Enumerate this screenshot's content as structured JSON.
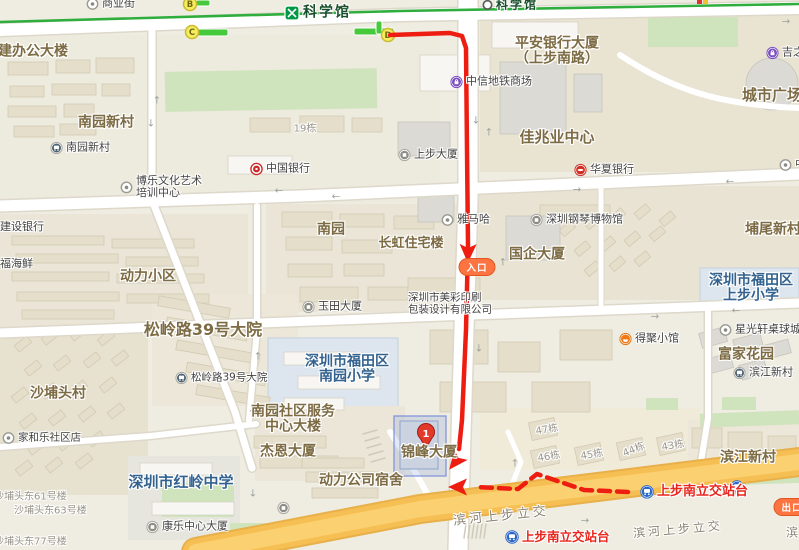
{
  "colors": {
    "route": "#ee1d11",
    "metro_line": "#2fae3e",
    "highway": "#f6bf53",
    "highway_edge": "#e8b04a",
    "transit": "#e8261d",
    "area": "#7d6b44",
    "school": "#33628f",
    "grey": "#98948a",
    "poi": "#434343",
    "roadlbl": "#8a8272",
    "station": "#174f2b",
    "capsule": "#fd7443",
    "exit_fill": "#f6ec5d",
    "exit_ring": "#c9bb2e",
    "exit_letter": "#6f6a15",
    "bus_blue": "#2a66c8"
  },
  "metro": {
    "line": [
      [
        0,
        22
      ],
      [
        400,
        11
      ],
      [
        799,
        4
      ]
    ],
    "logo": {
      "x": 292,
      "y": 13
    },
    "exits": [
      {
        "t": "B",
        "x": 190,
        "y": 4
      },
      {
        "t": "C",
        "x": 192,
        "y": 32
      },
      {
        "t": "D",
        "x": 388,
        "y": 35
      }
    ],
    "exit_bars": [
      [
        196,
        0,
        14,
        6
      ],
      [
        197,
        29,
        31,
        7
      ],
      [
        354,
        28,
        40,
        7
      ],
      [
        376,
        21,
        6,
        13
      ]
    ],
    "partial_marker": {
      "x": 697,
      "y": 0
    }
  },
  "route": {
    "main": [
      [
        390,
        35
      ],
      [
        450,
        33
      ],
      [
        462,
        36
      ],
      [
        466,
        48
      ],
      [
        467,
        150
      ],
      [
        468,
        246
      ],
      [
        466,
        330
      ],
      [
        462,
        420
      ],
      [
        459,
        449
      ]
    ],
    "main_arrows": [
      {
        "x": 468,
        "y": 252,
        "a": 91
      },
      {
        "x": 456,
        "y": 461,
        "a": 128
      }
    ],
    "dashed": [
      [
        628,
        492
      ],
      [
        584,
        490
      ],
      [
        537,
        474
      ],
      [
        518,
        489
      ],
      [
        476,
        487
      ]
    ],
    "dashed_arrows": [
      {
        "x": 459,
        "y": 487,
        "a": 180
      }
    ],
    "entrance": {
      "t": "入口",
      "x": 477,
      "y": 267
    },
    "exit": {
      "t": "出口",
      "x": 792,
      "y": 507
    }
  },
  "destination": {
    "number": "1",
    "x": 426,
    "y": 448,
    "building": {
      "x": 394,
      "y": 416,
      "w": 52,
      "h": 60
    }
  },
  "road_arrows": [
    {
      "g": "↑",
      "x": 157,
      "y": 101
    },
    {
      "g": "↓",
      "x": 151,
      "y": 124
    },
    {
      "g": "↓",
      "x": 476,
      "y": 121
    },
    {
      "g": "↑",
      "x": 489,
      "y": 133
    },
    {
      "g": "←",
      "x": 279,
      "y": 191
    },
    {
      "g": "←",
      "x": 336,
      "y": 197
    },
    {
      "g": "→",
      "x": 577,
      "y": 190
    },
    {
      "g": "←",
      "x": 730,
      "y": 182
    },
    {
      "g": "→",
      "x": 655,
      "y": 317
    },
    {
      "g": "←",
      "x": 736,
      "y": 311
    },
    {
      "g": "↑",
      "x": 258,
      "y": 357
    },
    {
      "g": "↑",
      "x": 252,
      "y": 414
    },
    {
      "g": "↓",
      "x": 253,
      "y": 494
    },
    {
      "g": "↑",
      "x": 503,
      "y": 263
    },
    {
      "g": "↓",
      "x": 479,
      "y": 349
    },
    {
      "g": "→",
      "x": 585,
      "y": 521
    },
    {
      "g": "↑",
      "x": 515,
      "y": 464
    },
    {
      "g": "→",
      "x": 786,
      "y": 22
    }
  ],
  "labels": [
    {
      "t": "建办公大楼",
      "x": -2,
      "y": 52,
      "cls": "area",
      "size": 14,
      "anchor": "l",
      "name": "area-jian-bangong-dalou",
      "inter": false
    },
    {
      "t": "南园新村",
      "x": 106,
      "y": 123,
      "cls": "area",
      "size": 14,
      "anchor": "c",
      "name": "area-nanyuan-xincun",
      "inter": false
    },
    {
      "t": "动力小区",
      "x": 148,
      "y": 277,
      "cls": "area",
      "size": 14,
      "anchor": "c",
      "name": "area-dongli-xiaoqu",
      "inter": false
    },
    {
      "t": "南园",
      "x": 331,
      "y": 230,
      "cls": "area",
      "size": 14,
      "anchor": "c",
      "name": "area-nanyuan",
      "inter": false
    },
    {
      "t": "长虹住宅楼",
      "x": 411,
      "y": 244,
      "cls": "area",
      "size": 13,
      "anchor": "c",
      "name": "area-changhong-zhuzhailou",
      "inter": false
    },
    {
      "t": "松岭路39号大院",
      "x": 203,
      "y": 330,
      "cls": "area",
      "size": 16,
      "anchor": "c",
      "name": "area-songlinglu-39",
      "inter": false
    },
    {
      "t": "沙埔头村",
      "x": 58,
      "y": 394,
      "cls": "area",
      "size": 14,
      "anchor": "c",
      "name": "area-shabutou-cun",
      "inter": false
    },
    {
      "lines": [
        "南园社区服务",
        "中心大楼"
      ],
      "x": 293,
      "y": 420,
      "cls": "area",
      "size": 14,
      "anchor": "c",
      "name": "area-nanyuan-shequ-center",
      "inter": false
    },
    {
      "t": "杰恩大厦",
      "x": 288,
      "y": 452,
      "cls": "area",
      "size": 14,
      "anchor": "c",
      "name": "area-jieen-dasha",
      "inter": false
    },
    {
      "t": "动力公司宿舍",
      "x": 361,
      "y": 481,
      "cls": "area",
      "size": 14,
      "anchor": "c",
      "name": "area-dongli-sushe",
      "inter": false
    },
    {
      "t": "锦峰大厦",
      "x": 429,
      "y": 453,
      "cls": "area",
      "size": 14,
      "anchor": "c",
      "name": "area-jinfeng-dasha",
      "inter": false
    },
    {
      "t": "国企大厦",
      "x": 537,
      "y": 255,
      "cls": "area",
      "size": 14,
      "anchor": "c",
      "name": "area-guoqi-dasha",
      "inter": false
    },
    {
      "t": "佳兆业中心",
      "x": 557,
      "y": 137,
      "cls": "area",
      "size": 15,
      "anchor": "c",
      "name": "area-jiazhaoye-center",
      "inter": false
    },
    {
      "lines": [
        "平安银行大厦",
        "（上步南路）"
      ],
      "x": 557,
      "y": 52,
      "cls": "area",
      "size": 14,
      "anchor": "c",
      "name": "area-pingan-bank-tower",
      "inter": false
    },
    {
      "t": "城市广场",
      "x": 772,
      "y": 95,
      "cls": "area",
      "size": 15,
      "anchor": "c",
      "name": "area-chengshi-guangchang",
      "inter": false
    },
    {
      "t": "埔尾新村",
      "x": 773,
      "y": 230,
      "cls": "area",
      "size": 14,
      "anchor": "c",
      "name": "area-puwei-xincun",
      "inter": false
    },
    {
      "t": "富家花园",
      "x": 746,
      "y": 355,
      "cls": "area",
      "size": 14,
      "anchor": "c",
      "name": "area-fujia-huayuan",
      "inter": false
    },
    {
      "t": "滨江新村",
      "x": 748,
      "y": 458,
      "cls": "area",
      "size": 14,
      "anchor": "c",
      "name": "area-binjiang-xincun",
      "inter": false
    },
    {
      "lines": [
        "深圳市福田区",
        "南园小学"
      ],
      "x": 347,
      "y": 370,
      "cls": "school",
      "size": 14,
      "anchor": "c",
      "name": "school-nanyuan-primary",
      "inter": false
    },
    {
      "lines": [
        "深圳市福田区",
        "上步小学"
      ],
      "x": 751,
      "y": 289,
      "cls": "school",
      "size": 14,
      "anchor": "c",
      "name": "school-shangbu-primary",
      "inter": false
    },
    {
      "t": "深圳市红岭中学",
      "x": 181,
      "y": 482,
      "cls": "school",
      "size": 15,
      "anchor": "c",
      "name": "school-hongling-middle",
      "inter": false
    },
    {
      "t": "19栋",
      "x": 305,
      "y": 129,
      "cls": "grey",
      "size": 10,
      "anchor": "c",
      "name": "bldg-no-19",
      "inter": false
    },
    {
      "t": "47栋",
      "x": 547,
      "y": 430,
      "cls": "grey",
      "size": 10,
      "anchor": "c",
      "rot": -10,
      "name": "bldg-no-47",
      "inter": false
    },
    {
      "t": "46栋",
      "x": 549,
      "y": 457,
      "cls": "grey",
      "size": 10,
      "anchor": "c",
      "rot": -10,
      "name": "bldg-no-46",
      "inter": false
    },
    {
      "t": "45栋",
      "x": 592,
      "y": 455,
      "cls": "grey",
      "size": 10,
      "anchor": "c",
      "rot": -10,
      "name": "bldg-no-45",
      "inter": false
    },
    {
      "t": "44栋",
      "x": 634,
      "y": 450,
      "cls": "grey",
      "size": 10,
      "anchor": "c",
      "rot": -22,
      "name": "bldg-no-44",
      "inter": false
    },
    {
      "t": "43栋",
      "x": 673,
      "y": 446,
      "cls": "grey",
      "size": 10,
      "anchor": "c",
      "rot": -10,
      "name": "bldg-no-43",
      "inter": false
    },
    {
      "t": "沙埔头东61号楼",
      "x": -6,
      "y": 497,
      "cls": "grey",
      "size": 10,
      "anchor": "l",
      "name": "bldg-shabutou-61",
      "inter": false
    },
    {
      "t": "沙埔头东63号楼",
      "x": 14,
      "y": 511,
      "cls": "grey",
      "size": 10,
      "anchor": "l",
      "name": "bldg-shabutou-63",
      "inter": false
    },
    {
      "t": "沙埔头东77号楼",
      "x": -6,
      "y": 542,
      "cls": "grey",
      "size": 10,
      "anchor": "l",
      "name": "bldg-shabutou-77",
      "inter": false
    },
    {
      "t": "商业街",
      "x": 86,
      "y": 4,
      "cls": "poi",
      "size": 11,
      "anchor": "l",
      "icon": "poi-dot",
      "name": "poi-shangyejie",
      "inter": true
    },
    {
      "t": "南园新村",
      "x": 50,
      "y": 148,
      "cls": "poi",
      "size": 11,
      "anchor": "l",
      "icon": "bus-grey",
      "name": "busstop-nanyuan-xincun",
      "inter": true
    },
    {
      "lines": [
        "博乐文化艺术",
        "培训中心"
      ],
      "x": 120,
      "y": 187,
      "cls": "poi",
      "size": 11,
      "anchor": "l",
      "icon": "poi-dot",
      "name": "poi-bole-art-center",
      "inter": true
    },
    {
      "t": "中国银行",
      "x": 250,
      "y": 169,
      "cls": "poi",
      "size": 11,
      "anchor": "l",
      "icon": "bank-red",
      "name": "poi-bank-of-china",
      "inter": true
    },
    {
      "t": "建设银行",
      "x": 0,
      "y": 227,
      "cls": "poi",
      "size": 11,
      "anchor": "l",
      "name": "poi-ccb-bank",
      "inter": true
    },
    {
      "t": "福海鲜",
      "x": 0,
      "y": 264,
      "cls": "poi",
      "size": 11,
      "anchor": "l",
      "name": "poi-fuhaixian",
      "inter": true
    },
    {
      "t": "玉田大厦",
      "x": 302,
      "y": 307,
      "cls": "poi",
      "size": 11,
      "anchor": "l",
      "icon": "poi-building",
      "name": "poi-yutian-dasha",
      "inter": true
    },
    {
      "t": "松岭路39号大院",
      "x": 175,
      "y": 378,
      "cls": "poi",
      "size": 10.5,
      "anchor": "l",
      "icon": "bus-grey",
      "name": "busstop-songlinglu-39",
      "inter": true
    },
    {
      "lines": [
        "深圳市美彩印刷",
        "包装设计有限公司"
      ],
      "x": 408,
      "y": 304,
      "cls": "poi",
      "size": 10.5,
      "anchor": "l",
      "name": "poi-meicai-printing",
      "inter": true
    },
    {
      "t": "家和乐社区店",
      "x": 2,
      "y": 438,
      "cls": "poi",
      "size": 10.5,
      "anchor": "l",
      "icon": "poi-dot",
      "name": "poi-jiahele-store",
      "inter": true
    },
    {
      "t": "康乐中心大厦",
      "x": 146,
      "y": 527,
      "cls": "poi",
      "size": 11,
      "anchor": "l",
      "icon": "poi-building",
      "name": "poi-kangle-center",
      "inter": true
    },
    {
      "t": "上步大厦",
      "x": 398,
      "y": 155,
      "cls": "poi",
      "size": 11,
      "anchor": "l",
      "icon": "poi-building",
      "name": "poi-shangbu-dasha",
      "inter": true
    },
    {
      "t": "雅马哈",
      "x": 441,
      "y": 220,
      "cls": "poi",
      "size": 11,
      "anchor": "l",
      "icon": "poi-dot",
      "name": "poi-yamaha",
      "inter": true
    },
    {
      "t": "中信地铁商场",
      "x": 450,
      "y": 82,
      "cls": "poi",
      "size": 11,
      "anchor": "l",
      "icon": "mall-purple",
      "name": "poi-zhongxin-metro-mall",
      "inter": true
    },
    {
      "t": "吉之岛",
      "x": 766,
      "y": 53,
      "cls": "poi",
      "size": 11,
      "anchor": "l",
      "icon": "mall-purple",
      "name": "poi-jizhidao",
      "inter": true
    },
    {
      "t": "华夏银行",
      "x": 574,
      "y": 170,
      "cls": "poi",
      "size": 11,
      "anchor": "l",
      "icon": "bank-eye",
      "name": "poi-huaxia-bank",
      "inter": true
    },
    {
      "t": "深圳钢琴博物馆",
      "x": 530,
      "y": 220,
      "cls": "poi",
      "size": 11,
      "anchor": "l",
      "icon": "poi-building",
      "name": "poi-piano-museum",
      "inter": true
    },
    {
      "t": "得聚小馆",
      "x": 619,
      "y": 339,
      "cls": "poi",
      "size": 11,
      "anchor": "l",
      "icon": "food-orange",
      "name": "poi-deju-restaurant",
      "inter": true
    },
    {
      "t": "星光轩桌球城",
      "x": 719,
      "y": 330,
      "cls": "poi",
      "size": 11,
      "anchor": "l",
      "icon": "poi-dot",
      "name": "poi-xingguangxuan-billiards",
      "inter": true
    },
    {
      "t": "滨江新村",
      "x": 733,
      "y": 373,
      "cls": "poi",
      "size": 11,
      "anchor": "l",
      "icon": "bus-grey",
      "name": "busstop-binjiang-xincun",
      "inter": true
    },
    {
      "t": "中",
      "x": 779,
      "y": 165,
      "cls": "poi",
      "size": 11,
      "anchor": "l",
      "icon": "poi-dot",
      "name": "poi-partial-zhong",
      "inter": true
    },
    {
      "t": "",
      "x": 277,
      "y": 508,
      "cls": "poi",
      "size": 10,
      "anchor": "l",
      "icon": "poi-building",
      "name": "poi-unlabeled-icon",
      "inter": true
    },
    {
      "t": "滨河上步立交",
      "x": 501,
      "y": 517,
      "cls": "road",
      "size": 13,
      "anchor": "c",
      "rot": -6,
      "name": "roadname-binhe-shangbu-1",
      "inter": false
    },
    {
      "t": "滨河上步立交",
      "x": 678,
      "y": 530,
      "cls": "road",
      "size": 12,
      "anchor": "c",
      "rot": -5,
      "name": "roadname-binhe-shangbu-2",
      "inter": false
    },
    {
      "t": "滨",
      "x": 786,
      "y": 533,
      "cls": "road",
      "size": 12,
      "anchor": "l",
      "name": "roadname-partial-bin",
      "inter": false
    },
    {
      "t": "",
      "x": 730,
      "y": 487,
      "cls": "poi",
      "size": 11,
      "anchor": "l",
      "icon": "bus-blue",
      "name": "busstop-icon-shangbunan-extra",
      "inter": true
    },
    {
      "t": "上步南立交站台",
      "x": 640,
      "y": 492,
      "cls": "transit",
      "size": 13,
      "anchor": "l",
      "icon": "bus-blue",
      "name": "busstop-shangbunan-platform-1",
      "inter": true
    },
    {
      "t": "上步南立交站台",
      "x": 505,
      "y": 537,
      "cls": "transit",
      "size": 12.5,
      "anchor": "l",
      "icon": "bus-blue",
      "name": "busstop-shangbunan-platform-2",
      "inter": true
    },
    {
      "t": "科学馆",
      "x": 303,
      "y": 13,
      "cls": "station",
      "size": 14,
      "anchor": "l",
      "name": "metro-station-kexueguan-main",
      "inter": true
    },
    {
      "t": "科学馆",
      "x": 482,
      "y": 5,
      "cls": "station",
      "size": 12,
      "anchor": "l",
      "icon": "white-circle",
      "name": "metro-station-kexueguan-secondary",
      "inter": true
    }
  ]
}
